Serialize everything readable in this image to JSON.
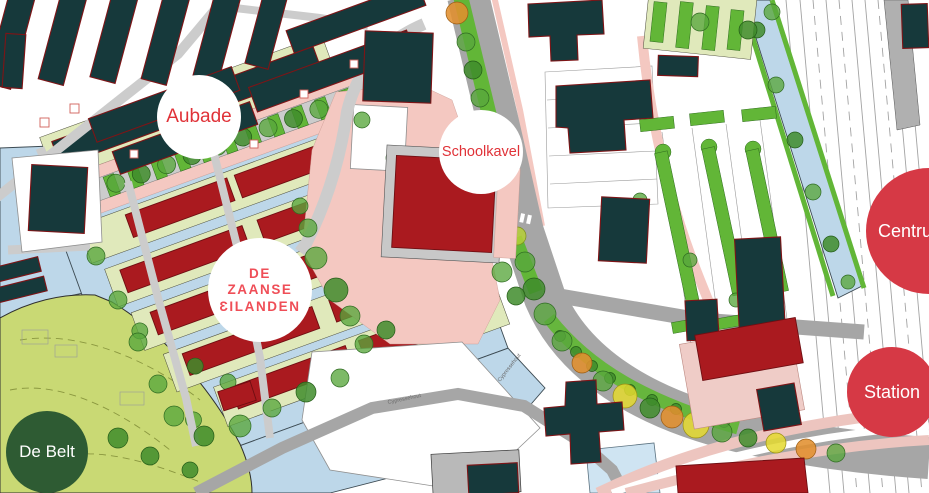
{
  "map": {
    "description": "Urban development plan map of De Zaanse Eilanden with labeled area markers",
    "markers": [
      {
        "id": "aubade",
        "label": "Aubade",
        "variant": "white"
      },
      {
        "id": "schoolkavel",
        "label": "Schoolkavel",
        "variant": "white"
      },
      {
        "id": "zaanse-eilanden",
        "lines": [
          "DE",
          "ZAANSE",
          "ƐILANDEN"
        ],
        "variant": "white"
      },
      {
        "id": "centrum",
        "label": "Centrum",
        "variant": "red"
      },
      {
        "id": "station",
        "label": "Station",
        "variant": "red"
      },
      {
        "id": "de-belt",
        "label": "De Belt",
        "variant": "green"
      }
    ],
    "street_labels": [
      "Cypressehout",
      "Cypressehout"
    ]
  },
  "colors": {
    "water": "#bdd7e9",
    "waterLight": "#cfe4f2",
    "park": "#c9d974",
    "parkLine": "#8a973f",
    "parcel": "#e0e9bb",
    "hedge": "#62b637",
    "treeGreen": "#58a73c",
    "treeDark": "#3f8c2c",
    "treeYG": "#b5cf36",
    "treeYellow": "#e4d92f",
    "treeOrange": "#e1902f",
    "teal": "#16393b",
    "tealStroke": "#7e1416",
    "red": "#aa1a1f",
    "redStroke": "#6f0e12",
    "roadGray": "#a6a6a6",
    "roadLight": "#cccccc",
    "pink": "#f4c8c1",
    "pinkLight": "#efccc7",
    "stationPink": "#edc5bf",
    "railLine": "#a3a3a3",
    "grayBldg": "#b9b9b9",
    "lotLine": "#9a9a9a",
    "markerWhite": "#ffffff",
    "markerRed": "#d63945",
    "markerGreen": "#2e5b33",
    "markerTextRed": "#e03238",
    "markerTextWhite": "#ffffff",
    "zaanseText": "#ef4e57"
  }
}
